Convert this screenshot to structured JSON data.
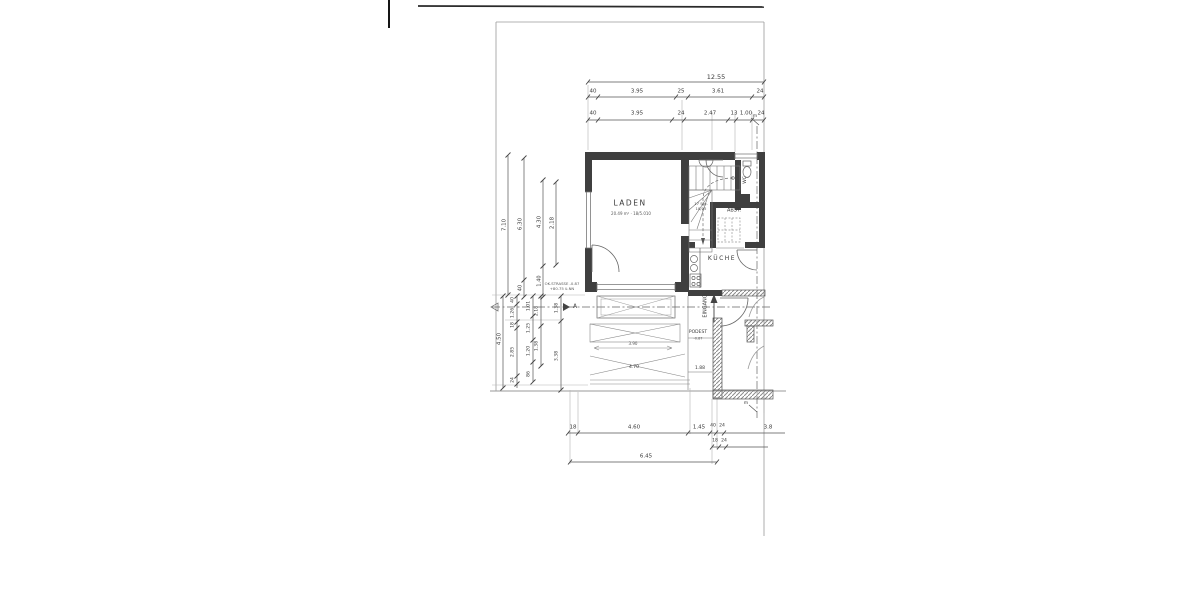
{
  "plan": {
    "rooms": {
      "laden": {
        "label": "LADEN",
        "note": "20.49 m² · 18/5.010"
      },
      "kueche": {
        "label": "KÜCHE"
      },
      "abst": {
        "label": "ABST."
      },
      "wc": {
        "label": "WC"
      }
    },
    "annotations": {
      "eingang": "EINGANG",
      "podest": "PODEST",
      "podest_level": "-0.87",
      "stairs_1": "17 Stg.",
      "stairs_2": "18/25",
      "street_1": "OK.STRASSE -0.87",
      "street_2": "+80.75 ü.NN",
      "section": "A",
      "axis": "m",
      "ramp_mid": "3.90",
      "ramp_len": "4.70",
      "ramp_w": "1.88"
    },
    "dims": {
      "top_total": "12.55",
      "top_row1": [
        "40",
        "3.95",
        "25",
        "3.61",
        "24"
      ],
      "top_row2": [
        "40",
        "3.95",
        "24",
        "2.47",
        "13",
        "1.00",
        "24"
      ],
      "left_upper": [
        "7.10",
        "6.30",
        "4.30",
        "2.18",
        "1.40",
        "40"
      ],
      "left_lower_total": "4.50",
      "left_col_b": [
        "40",
        "1.26",
        "18",
        "2.85",
        "24"
      ],
      "left_col_c": [
        "1.01",
        "1.25",
        "1.20",
        "86"
      ],
      "left_col_d": [
        "2.18",
        "1.38"
      ],
      "left_col_e": [
        "1.38",
        "3.38"
      ],
      "bottom_row1": [
        "18",
        "4.60",
        "1.45",
        "40",
        "24",
        "3.8"
      ],
      "bottom_row2": [
        "18",
        "24"
      ],
      "bottom_total": "6.45"
    }
  }
}
